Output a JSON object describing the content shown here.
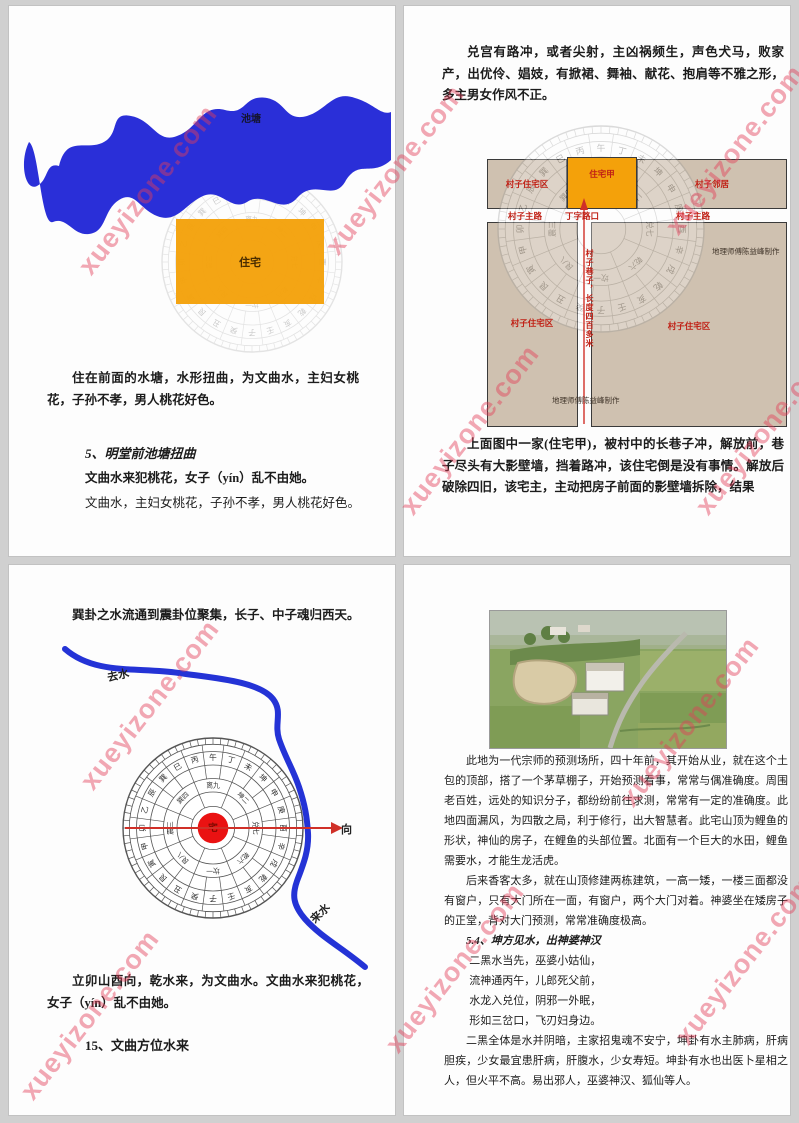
{
  "watermark": {
    "text": "xueyizone.com",
    "color": "#e23e58"
  },
  "compass": {
    "ring24": [
      "午",
      "丁",
      "未",
      "坤",
      "申",
      "庚",
      "酉",
      "辛",
      "戌",
      "乾",
      "亥",
      "壬",
      "子",
      "癸",
      "丑",
      "艮",
      "寅",
      "甲",
      "卯",
      "乙",
      "辰",
      "巽",
      "巳",
      "丙"
    ],
    "trigrams": [
      "离九",
      "坤二",
      "兑七",
      "乾六",
      "坎一",
      "艮八",
      "震三",
      "巽四"
    ],
    "center": "宅"
  },
  "page1": {
    "pond_label": "池塘",
    "house_label": "住宅",
    "para1": "住在前面的水塘，水形扭曲，为文曲水，主妇女桃花，子孙不孝，男人桃花好色。",
    "heading": "5、明堂前池塘扭曲",
    "line1": "文曲水来犯桃花，女子（yín）乱不由她。",
    "line2": "文曲水，主妇女桃花，子孙不孝，男人桃花好色。"
  },
  "page2": {
    "para_top": "兑宫有路冲，或者尖射，主凶祸频生，声色犬马，败家产，出优伶、娼妓，有掀裙、舞袖、献花、抱肩等不雅之形，多主男女作风不正。",
    "diagram": {
      "block_top_left": "村子住宅区",
      "house": "住宅甲",
      "block_top_right": "村子邻居",
      "road_left": "村子主路",
      "junction": "丁字路口",
      "road_right": "村子主路",
      "block_bottom_left": "村子住宅区",
      "block_bottom_right": "村子住宅区",
      "alley": "村子巷子，长度四百多米",
      "credit": "地理师傅陈益峰制作"
    },
    "para_bottom": "上面图中一家(住宅甲)，被村中的长巷子冲，解放前，巷子尽头有大影壁墙，挡着路冲，该住宅倒是没有事情。解放后破除四旧，该宅主，主动把房子前面的影壁墙拆除，结果"
  },
  "page3": {
    "para_top": "巽卦之水流通到震卦位聚集，长子、中子魂归西天。",
    "labels": {
      "outgoing": "去水",
      "incoming": "来水",
      "facing": "向"
    },
    "para_bottom": "立卯山酉向，乾水来，为文曲水。文曲水来犯桃花，女子（yín）乱不由她。",
    "heading": "15、文曲方位水来"
  },
  "page4": {
    "para1": "此地为一代宗师的预测场所，四十年前，其开始从业，就在这个土包的顶部，搭了一个茅草棚子，开始预测看事，常常与偶准确度。周围老百姓，远处的知识分子，都纷纷前往求测，常常有一定的准确度。此地四面漏风，为四散之局，利于修行，出大智慧者。此宅山顶为鲤鱼的形状，神仙的房子，在鲤鱼的头部位置。北面有一个巨大的水田，鲤鱼需要水，才能生龙活虎。",
    "para2": "后来香客太多，就在山顶修建两栋建筑，一高一矮，一楼三面都没有窗户，只有大门所在一面，有窗户，两个大门对着。神婆坐在矮房子的正堂，背对大门预测，常常准确度极高。",
    "heading": "5.4、坤方见水，出神婆神汉",
    "verse": [
      "二黑水当先，巫婆小姑仙，",
      "流神通丙午，儿郎死父前，",
      "水龙入兑位，阴邪一外眠，",
      "形如三岔口，飞刃妇身边。"
    ],
    "para3": "二黑全体是水并阴暗，主家招鬼魂不安宁，坤卦有水主肺病，肝病胆疾，少女最宜患肝病，肝腹水，少女寿短。坤卦有水也出医卜星相之人，但火平不高。易出邪人，巫婆神汉、狐仙等人。"
  }
}
